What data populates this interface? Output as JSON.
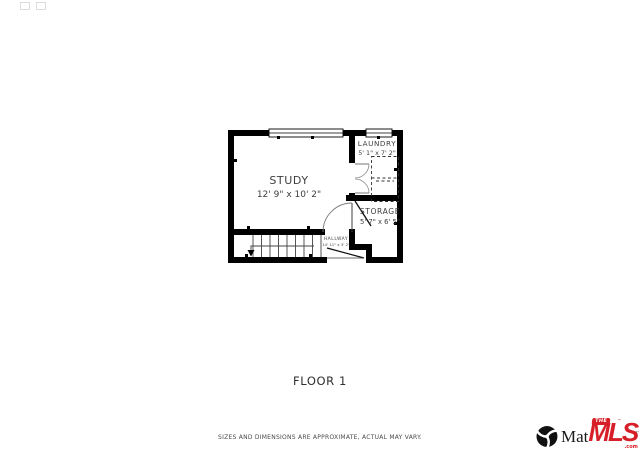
{
  "plan": {
    "floor_label": "FLOOR 1",
    "rooms": {
      "study": {
        "name": "STUDY",
        "dims": "12' 9\" x 10' 2\""
      },
      "laundry": {
        "name": "LAUNDRY",
        "dims": "5' 1\" x 7' 2\""
      },
      "storage": {
        "name": "STORAGE",
        "dims": "5' 7\" x 6' 5\""
      },
      "hallway": {
        "name": "HALLWAY",
        "dims": "14' 11\" x 3' 2\""
      }
    }
  },
  "footer": {
    "disclaimer": "SIZES AND DIMENSIONS ARE APPROXIMATE, ACTUAL MAY VARY."
  },
  "branding": {
    "matrix_text_visible": "Mat",
    "matrix_text_fragment": "r",
    "mls": {
      "the": "THE",
      "mls": "MLS",
      "tm": "™",
      "com": ".com"
    }
  },
  "colors": {
    "wall": "#000000",
    "room_text": "#3e3e3e",
    "brand_red": "#d71f27",
    "logo_black": "#111111"
  }
}
